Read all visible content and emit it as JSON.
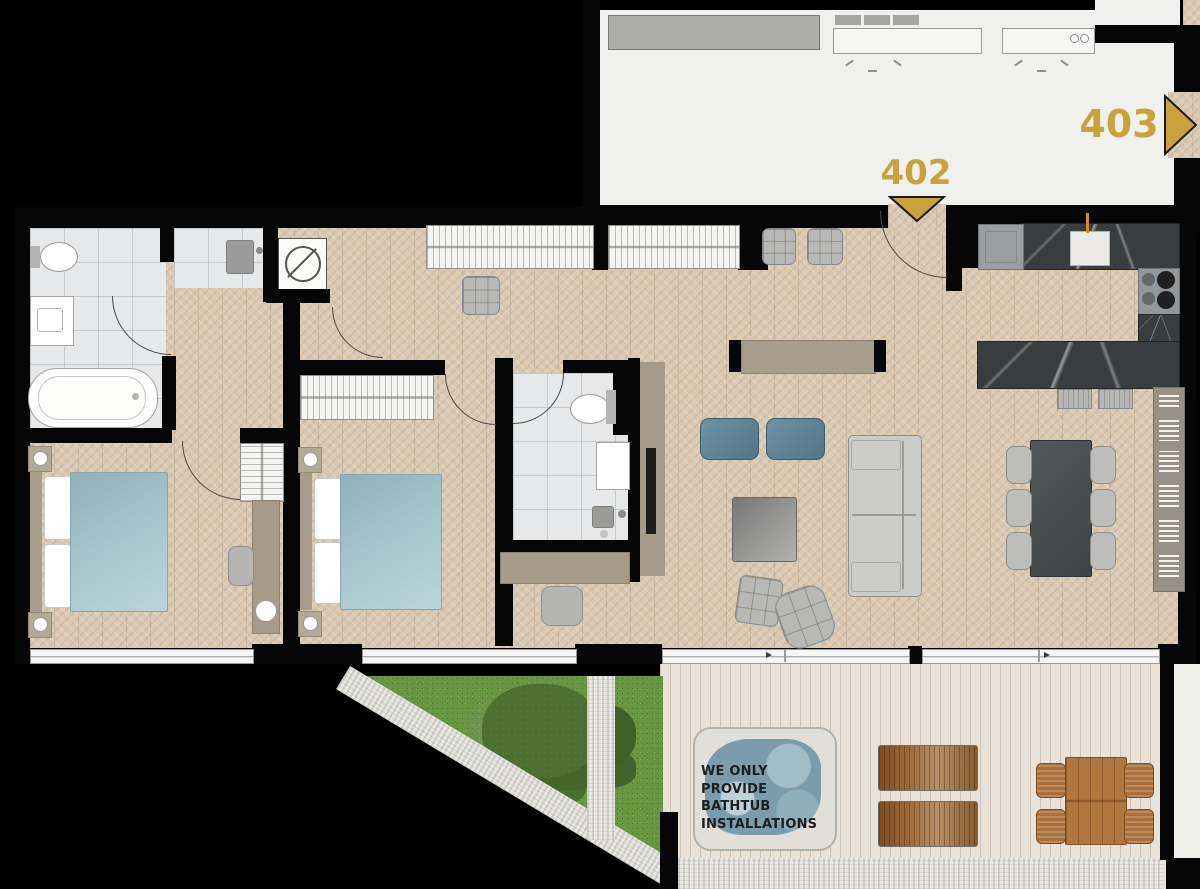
{
  "units": [
    {
      "label": "402",
      "arrow_direction": "down"
    },
    {
      "label": "403",
      "arrow_direction": "right"
    }
  ],
  "disclaimer": {
    "line1": "WE ONLY PROVIDE",
    "line2": "BATHTUB",
    "line3": "INSTALLATIONS"
  },
  "colors": {
    "accent_gold": "#C9A23C",
    "wall_black": "#060606",
    "wood_floor": "#d9c8b2",
    "tile_gray": "#e6e8e9",
    "corridor_white": "#f0f0ee",
    "deck_wood": "#e9e2d9",
    "marble_dark": "#3a3d3f",
    "grass_green": "#699640",
    "water_blue": "#7b9cad",
    "bed_blue": "#a9c7ce",
    "outdoor_brown": "#b0763f"
  }
}
